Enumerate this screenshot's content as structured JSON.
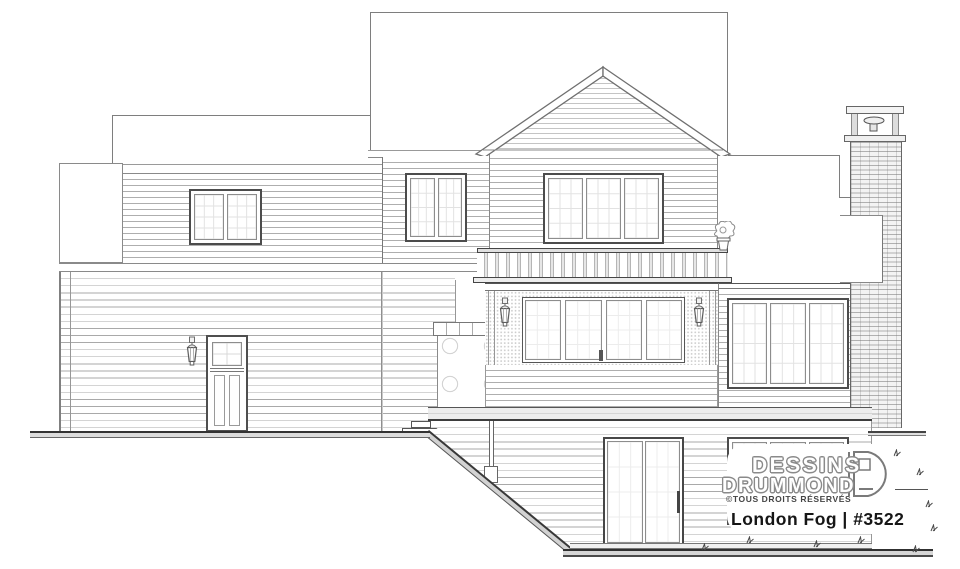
{
  "branding": {
    "name_line1": "DESSINS",
    "name_line2": "DRUMMOND",
    "rights_notice": "©TOUS DROITS RÉSERVÉS",
    "plan_title": "London Fog | #3522",
    "logo_icon": "drummond-d-icon"
  },
  "drawing": {
    "kind": "house rear elevation line drawing",
    "features": [
      "main roof",
      "center gable with horizontal siding",
      "left wing with double window",
      "second-floor double and triple windows",
      "balcony railing with balusters",
      "screened porch with four sliding panels",
      "two porch wall lanterns",
      "back door with wall lantern",
      "stone pillar",
      "brick chimney with flue pot",
      "first-floor triple window",
      "walk-out basement with sliding patio door",
      "basement triple window",
      "deck band with support post",
      "sloped grade down to lower patio",
      "grass tufts"
    ]
  },
  "colors": {
    "background": "#ffffff",
    "line_light": "#b5b5b5",
    "line_medium": "#6e6e6e",
    "line_dark": "#303030",
    "text_dark": "#161616",
    "logo_outline": "#8a8a8a"
  },
  "icons": {
    "wall-lantern-icon": "outdoor sconce lantern, svg outline",
    "flower-pot-icon": "potted plant on balcony end, svg outline",
    "chimney-flue-icon": "flue pot on chimney cap, svg outline",
    "grass-tuft-icon": "small grass tick mark, svg strokes",
    "drummond-d-icon": "Drummond D logomark, svg outline"
  }
}
